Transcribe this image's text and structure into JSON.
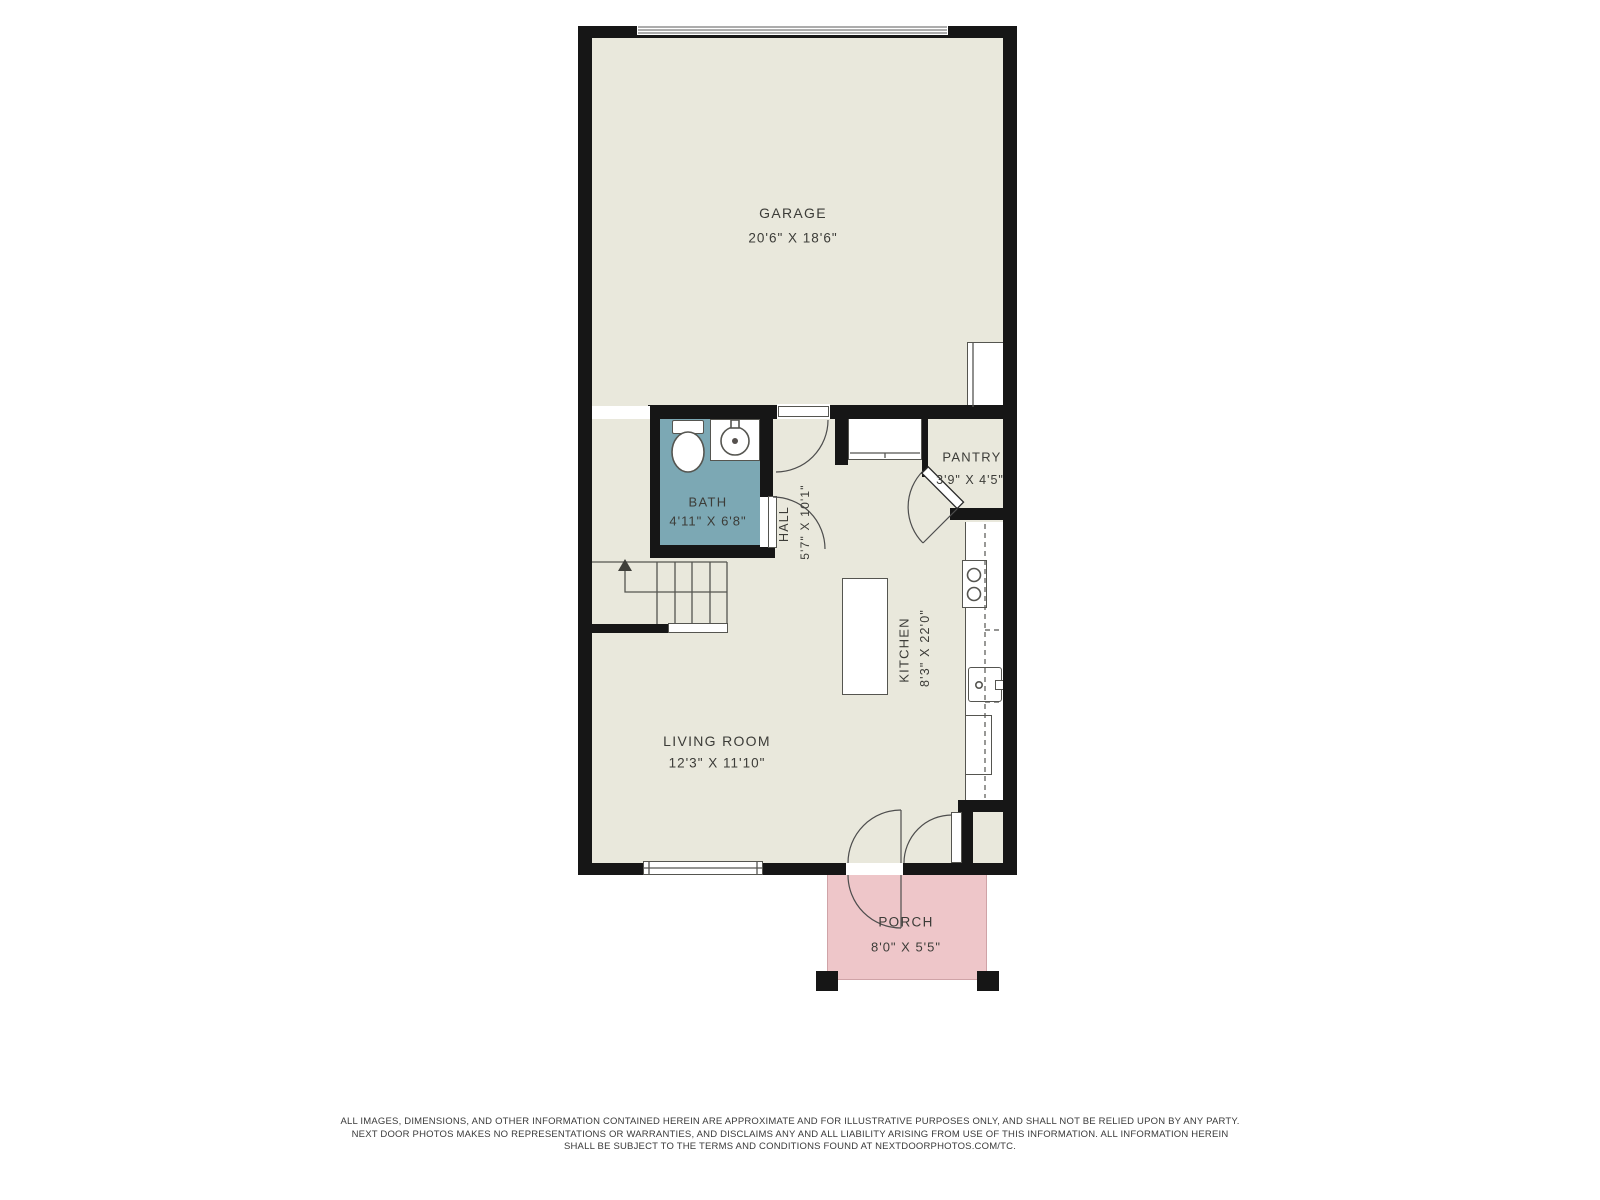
{
  "rooms": {
    "garage": {
      "name": "GARAGE",
      "dims": "20'6\" X 18'6\""
    },
    "bath": {
      "name": "BATH",
      "dims": "4'11\" X 6'8\""
    },
    "hall": {
      "name": "HALL",
      "dims": "5'7\" X 10'1\""
    },
    "pantry": {
      "name": "PANTRY",
      "dims": "3'9\" X 4'5\""
    },
    "kitchen": {
      "name": "KITCHEN",
      "dims": "8'3\" X 22'0\""
    },
    "living_room": {
      "name": "LIVING ROOM",
      "dims": "12'3\" X 11'10\""
    },
    "porch": {
      "name": "PORCH",
      "dims": "8'0\" X 5'5\""
    }
  },
  "disclaimer": {
    "line1": "ALL IMAGES, DIMENSIONS, AND OTHER INFORMATION CONTAINED HEREIN ARE APPROXIMATE AND FOR ILLUSTRATIVE PURPOSES ONLY, AND SHALL NOT BE RELIED UPON BY ANY PARTY.",
    "line2": "NEXT DOOR PHOTOS MAKES NO REPRESENTATIONS OR WARRANTIES, AND DISCLAIMS ANY AND ALL LIABILITY ARISING FROM USE OF THIS INFORMATION. ALL INFORMATION HEREIN",
    "line3": "SHALL BE SUBJECT TO THE TERMS AND CONDITIONS FOUND AT NEXTDOORPHOTOS.COM/TC."
  },
  "colors": {
    "floor": "#e9e8dc",
    "bath": "#7ca8b4",
    "porch": "#eec6c9",
    "wall": "#161616",
    "line": "#555550",
    "text": "#3c3c38",
    "gdline": "#909090"
  }
}
